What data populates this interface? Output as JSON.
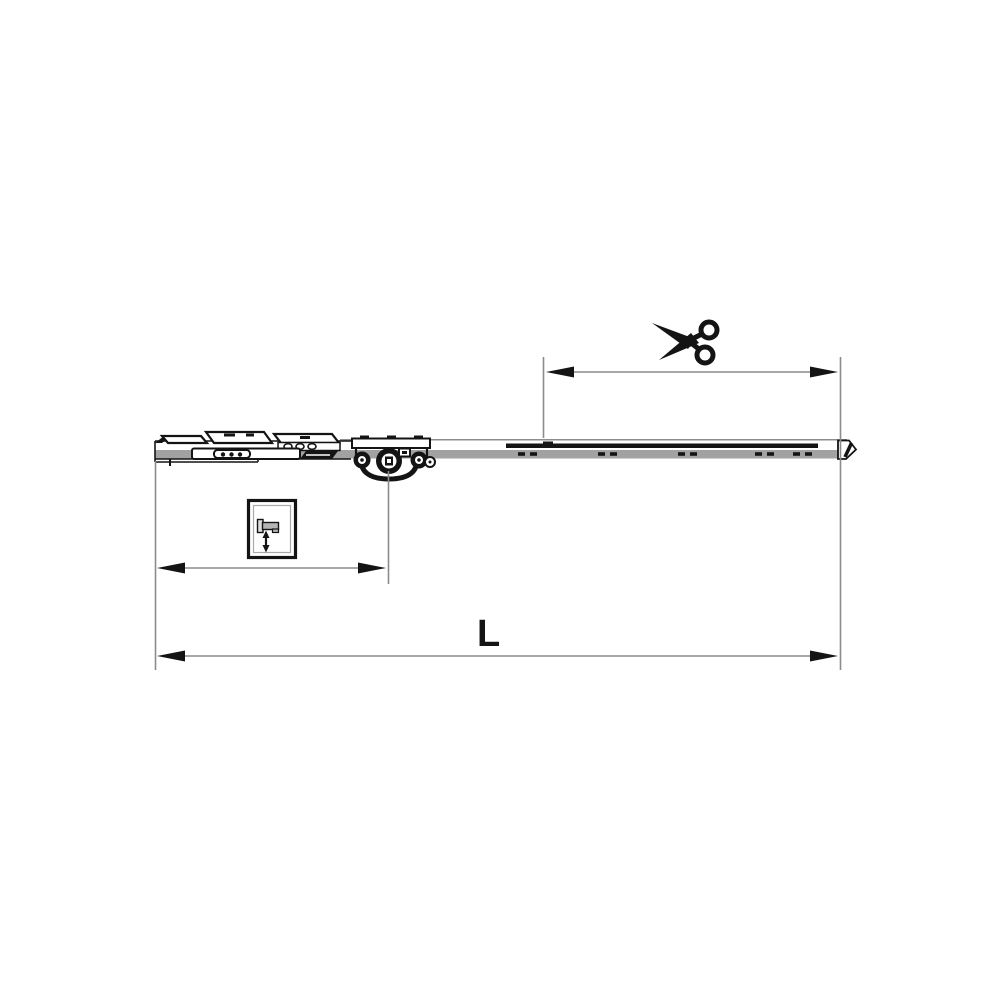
{
  "diagram": {
    "kind": "technical-line-drawing",
    "subject": "window-gear-rail-with-cut-to-length-section",
    "background": "#ffffff",
    "line_color": "#141414",
    "secondary_color": "#8c8c8c",
    "rail_fill": "#a2a2a2",
    "labels": {
      "total_length": "L"
    },
    "dimensions": [
      {
        "id": "cut-length",
        "label": ""
      },
      {
        "id": "handle-offset",
        "label": ""
      },
      {
        "id": "total-length",
        "label": "L"
      }
    ],
    "icons": [
      {
        "name": "scissors-icon"
      },
      {
        "name": "handle-height-adjustment-icon"
      }
    ]
  }
}
